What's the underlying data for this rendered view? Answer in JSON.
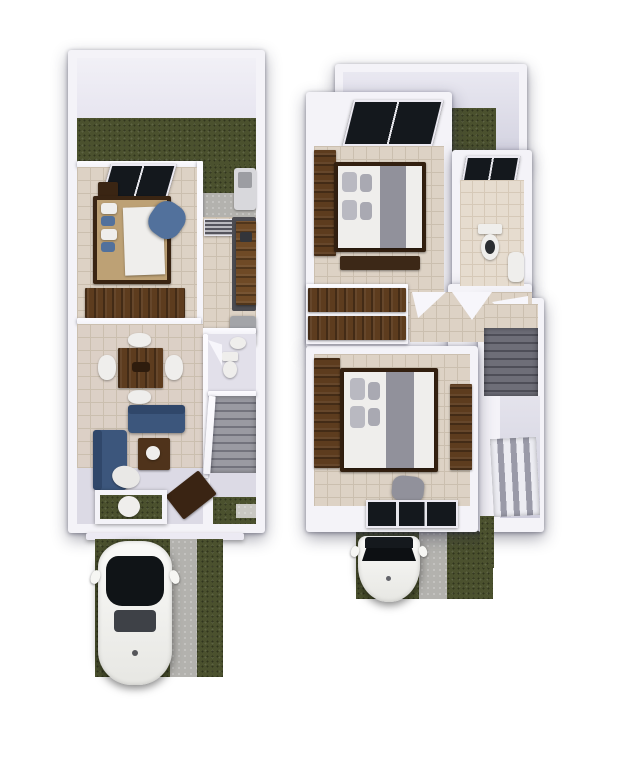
{
  "scene": {
    "type": "3d-floor-plan-render",
    "width": 623,
    "height": 764,
    "background": "#ffffff",
    "text": [],
    "floors": [
      {
        "name": "ground-floor",
        "rooms": [
          "backyard-patio",
          "bedroom",
          "kitchen",
          "dining-area",
          "living-room",
          "half-bathroom",
          "staircase",
          "entry",
          "front-yard",
          "driveway"
        ],
        "objects": [
          "laundry-sink",
          "bedroom-window",
          "double-bed",
          "nightstand",
          "blue-armchair",
          "wardrobe",
          "kitchen-blinds",
          "kitchen-counter",
          "refrigerator",
          "dining-table",
          "dining-chairs",
          "sofa",
          "chaise-sofa",
          "coffee-table",
          "toilet",
          "bathroom-sink",
          "stairs",
          "front-door",
          "porch-planter",
          "white-car"
        ]
      },
      {
        "name": "upper-floor",
        "rooms": [
          "patio-void",
          "master-bedroom",
          "bathroom",
          "hallway",
          "closet",
          "second-bedroom",
          "stairwell",
          "double-height-void",
          "driveway"
        ],
        "objects": [
          "master-window",
          "master-closet",
          "master-bed",
          "bed-bench",
          "bathroom-window",
          "toilet",
          "bathroom-sink",
          "open-doors",
          "closet-shelves",
          "wardrobe",
          "second-bed",
          "pouf",
          "desk",
          "bedroom-window",
          "stairs",
          "window-slats",
          "white-car-front"
        ]
      }
    ]
  },
  "palette": {
    "wall": "#f4f3f8",
    "wall_face": "#e7e5f0",
    "wall_edge": "#cfcdda",
    "lilac": "#dcdae5",
    "grass": "#4b512e",
    "concrete": "#b3b2ae",
    "concrete_light": "#c8c7c2",
    "tile": "#ddd2c5",
    "tile_line": "#cbbfaf",
    "tile_light": "#e6dccf",
    "tile_light_line": "#d6c9b8",
    "wood": "#5d3c1e",
    "wood_dark": "#3a2513",
    "bed_tan": "#bda175",
    "soft_white": "#efeeec",
    "blanket_gray": "#91919b",
    "pillow_gray": "#b9b9c1",
    "sofa_blue": "#3c567c",
    "sofa_blue_dark": "#30476a",
    "pillow_blue": "#52719c",
    "window_dark": "#14181d",
    "stair": "#9a9aa2",
    "stair_dark": "#73737d",
    "stair_deep": "#4e4e58",
    "slat_light": "#ececf2",
    "slat_dark": "#9a9aa8",
    "car_white": "#f6f6f3",
    "car_glass": "#101417",
    "metal": "#a3a4a8"
  }
}
